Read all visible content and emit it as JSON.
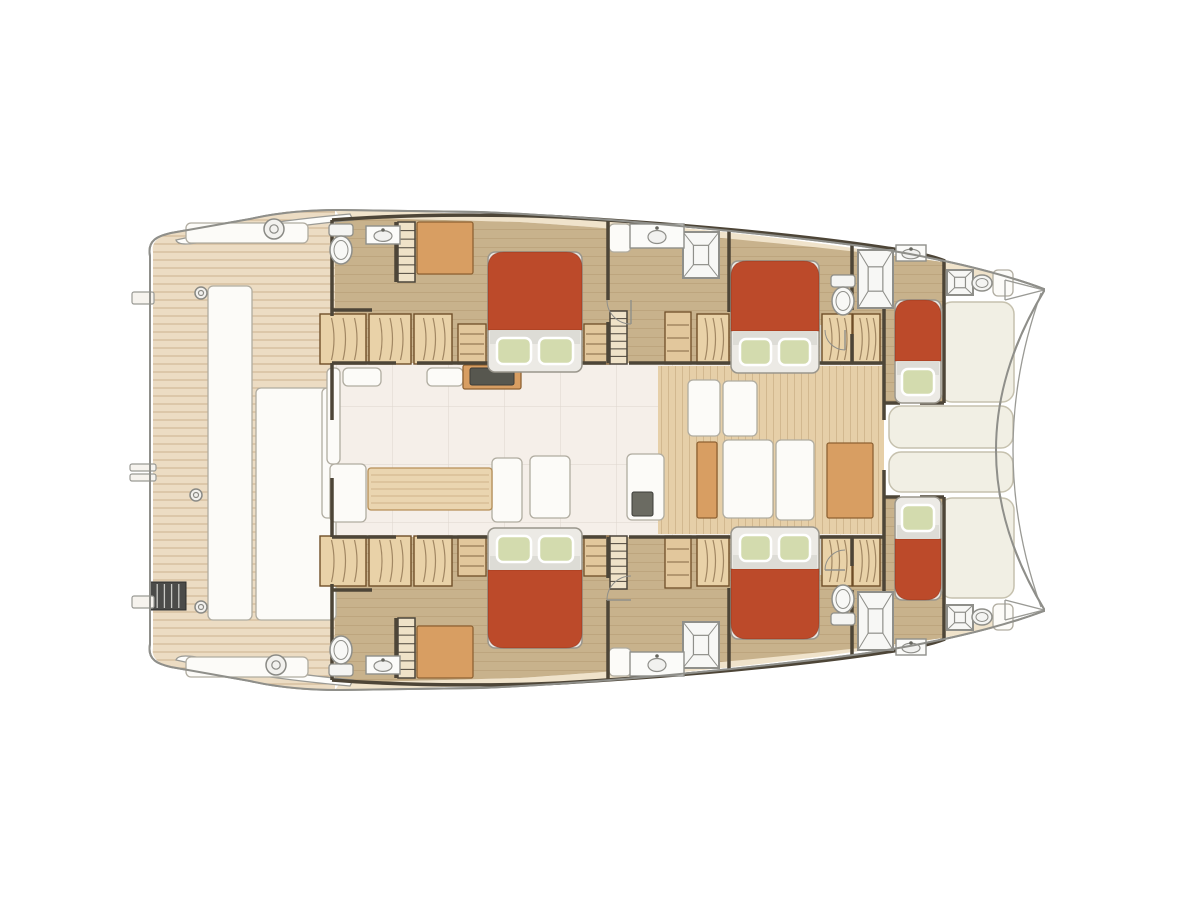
{
  "meta": {
    "title": "catamaran-deck-plan",
    "view": "top-down interior layout, bow right, stern left",
    "hulls": 2,
    "double_cabins": 4,
    "single_forepeak_cabins": 2
  },
  "palette": {
    "hull_outline": "#8f8f8a",
    "wall": "#4d4537",
    "teak": "#ecdcc3",
    "teak_light": "#f0e3cb",
    "cabin_floor": "#c8b28c",
    "fwd_floor": "#e6cfa8",
    "salon_floor": "#f5efe9",
    "gray_floor": "#d2d2cb",
    "bed_red": "#bc4a2a",
    "mattress": "#eceae5",
    "band": "#dddcd6",
    "pillow": "#d3dbae",
    "wood": "#d89e62",
    "wood_light": "#ead5b0",
    "wardrobe": "#e9d2a8",
    "white_furn": "#fcfbf8",
    "cushion": "#f1efe4",
    "fixture": "#8f8f8a",
    "dark_ladder": "#4b4b49"
  },
  "plan": {
    "beds": [
      {
        "n": "bed-port-aft-cabin",
        "x": 488,
        "y": 252,
        "w": 94,
        "h": 120,
        "p": 2,
        "e": "bottom"
      },
      {
        "n": "bed-port-mid-cabin",
        "x": 731,
        "y": 261,
        "w": 88,
        "h": 112,
        "p": 2,
        "e": "bottom"
      },
      {
        "n": "bed-port-forepeak",
        "x": 895,
        "y": 300,
        "w": 46,
        "h": 103,
        "p": 1,
        "e": "bottom"
      },
      {
        "n": "bed-stbd-aft-cabin",
        "x": 488,
        "y": 528,
        "w": 94,
        "h": 120,
        "p": 2,
        "e": "top"
      },
      {
        "n": "bed-stbd-mid-cabin",
        "x": 731,
        "y": 527,
        "w": 88,
        "h": 112,
        "p": 2,
        "e": "top"
      },
      {
        "n": "bed-stbd-forepeak",
        "x": 895,
        "y": 497,
        "w": 46,
        "h": 103,
        "p": 1,
        "e": "top"
      }
    ],
    "showers": [
      {
        "n": "shower-port-mid",
        "x": 683,
        "y": 232,
        "w": 36,
        "h": 46
      },
      {
        "n": "shower-port-fwd",
        "x": 858,
        "y": 250,
        "w": 35,
        "h": 58
      },
      {
        "n": "shower-bow-port",
        "x": 947,
        "y": 270,
        "w": 26,
        "h": 25
      },
      {
        "n": "shower-stbd-mid",
        "x": 683,
        "y": 622,
        "w": 36,
        "h": 46
      },
      {
        "n": "shower-stbd-fwd",
        "x": 858,
        "y": 592,
        "w": 35,
        "h": 58
      },
      {
        "n": "shower-bow-stbd",
        "x": 947,
        "y": 605,
        "w": 26,
        "h": 25
      }
    ],
    "toilets": [
      {
        "n": "toilet-port-aft",
        "cx": 341,
        "cy": 248,
        "dir": "down"
      },
      {
        "n": "toilet-port-fwd",
        "cx": 843,
        "cy": 299,
        "dir": "down"
      },
      {
        "n": "toilet-stbd-aft",
        "cx": 341,
        "cy": 652,
        "dir": "up"
      },
      {
        "n": "toilet-stbd-fwd",
        "cx": 843,
        "cy": 601,
        "dir": "up"
      },
      {
        "n": "toilet-bow-port",
        "cx": 982,
        "cy": 283,
        "mini": true
      },
      {
        "n": "toilet-bow-stbd",
        "cx": 982,
        "cy": 617,
        "mini": true
      }
    ],
    "sinks": [
      {
        "n": "sink-port-aft",
        "x": 366,
        "y": 226,
        "w": 34,
        "h": 18
      },
      {
        "n": "sink-port-mid",
        "x": 630,
        "y": 224,
        "w": 54,
        "h": 24
      },
      {
        "n": "sink-port-fwd",
        "x": 896,
        "y": 245,
        "w": 30,
        "h": 16
      },
      {
        "n": "sink-stbd-aft",
        "x": 366,
        "y": 656,
        "w": 34,
        "h": 18
      },
      {
        "n": "sink-stbd-mid",
        "x": 630,
        "y": 652,
        "w": 54,
        "h": 24
      },
      {
        "n": "sink-stbd-fwd",
        "x": 896,
        "y": 639,
        "w": 30,
        "h": 16
      }
    ],
    "wardrobes": [
      {
        "x": 320,
        "y": 314,
        "w": 46,
        "h": 50
      },
      {
        "x": 369,
        "y": 314,
        "w": 42,
        "h": 50
      },
      {
        "x": 414,
        "y": 314,
        "w": 38,
        "h": 50
      },
      {
        "x": 697,
        "y": 314,
        "w": 32,
        "h": 50
      },
      {
        "x": 822,
        "y": 314,
        "w": 30,
        "h": 50
      },
      {
        "x": 853,
        "y": 314,
        "w": 27,
        "h": 50
      },
      {
        "x": 320,
        "y": 536,
        "w": 46,
        "h": 50
      },
      {
        "x": 369,
        "y": 536,
        "w": 42,
        "h": 50
      },
      {
        "x": 414,
        "y": 536,
        "w": 38,
        "h": 50
      },
      {
        "x": 697,
        "y": 536,
        "w": 32,
        "h": 50
      },
      {
        "x": 822,
        "y": 536,
        "w": 30,
        "h": 50
      },
      {
        "x": 853,
        "y": 536,
        "w": 27,
        "h": 50
      }
    ],
    "shelves": [
      {
        "x": 458,
        "y": 324,
        "w": 28,
        "h": 40
      },
      {
        "x": 584,
        "y": 324,
        "w": 26,
        "h": 40
      },
      {
        "x": 665,
        "y": 312,
        "w": 26,
        "h": 52
      },
      {
        "x": 458,
        "y": 536,
        "w": 28,
        "h": 40
      },
      {
        "x": 584,
        "y": 536,
        "w": 26,
        "h": 40
      },
      {
        "x": 665,
        "y": 536,
        "w": 26,
        "h": 52
      }
    ],
    "stairs": [
      {
        "n": "stairs-port-aft",
        "x": 398,
        "y": 222,
        "w": 17,
        "h": 60
      },
      {
        "n": "stairs-port-mid",
        "x": 610,
        "y": 311,
        "w": 17,
        "h": 53
      },
      {
        "n": "stairs-stbd-aft",
        "x": 398,
        "y": 618,
        "w": 17,
        "h": 60
      },
      {
        "n": "stairs-stbd-mid",
        "x": 610,
        "y": 536,
        "w": 17,
        "h": 53
      }
    ],
    "cushions": [
      {
        "n": "foredeck-pad-port",
        "x": 940,
        "y": 302,
        "w": 74,
        "h": 100
      },
      {
        "n": "foredeck-pad-mid-a",
        "x": 889,
        "y": 406,
        "w": 124,
        "h": 42
      },
      {
        "n": "foredeck-pad-mid-b",
        "x": 889,
        "y": 452,
        "w": 124,
        "h": 40
      },
      {
        "n": "foredeck-pad-stbd",
        "x": 940,
        "y": 498,
        "w": 74,
        "h": 100
      }
    ],
    "white_furniture": [
      {
        "n": "aft-bench-port",
        "x": 186,
        "y": 223,
        "w": 122,
        "h": 20
      },
      {
        "n": "aft-bench-stbd",
        "x": 186,
        "y": 657,
        "w": 122,
        "h": 20
      },
      {
        "n": "cockpit-bench",
        "x": 208,
        "y": 286,
        "w": 44,
        "h": 334
      },
      {
        "n": "cockpit-lounge",
        "x": 256,
        "y": 388,
        "w": 80,
        "h": 232
      },
      {
        "n": "salon-sliding-door",
        "x": 322,
        "y": 388,
        "w": 14,
        "h": 130
      },
      {
        "n": "salon-sofa-left",
        "x": 327,
        "y": 368,
        "w": 13,
        "h": 96
      },
      {
        "n": "dinette-seat-aft",
        "x": 330,
        "y": 464,
        "w": 36,
        "h": 58
      },
      {
        "n": "dinette-seat-fwd",
        "x": 492,
        "y": 458,
        "w": 30,
        "h": 64
      },
      {
        "n": "salon-island-seat",
        "x": 530,
        "y": 456,
        "w": 40,
        "h": 62
      },
      {
        "n": "salon-cabinet-a",
        "x": 343,
        "y": 368,
        "w": 38,
        "h": 18
      },
      {
        "n": "salon-cabinet-b",
        "x": 427,
        "y": 368,
        "w": 36,
        "h": 18
      },
      {
        "n": "galley-sink-counter",
        "x": 627,
        "y": 454,
        "w": 37,
        "h": 66
      },
      {
        "n": "fwd-door-panel",
        "x": 723,
        "y": 440,
        "w": 50,
        "h": 78
      },
      {
        "n": "fwd-locker-panel",
        "x": 776,
        "y": 440,
        "w": 38,
        "h": 80
      },
      {
        "n": "glass-door-a",
        "x": 688,
        "y": 380,
        "w": 32,
        "h": 56
      },
      {
        "n": "glass-door-b",
        "x": 723,
        "y": 381,
        "w": 34,
        "h": 55
      },
      {
        "n": "head-shelf-port",
        "x": 609,
        "y": 224,
        "w": 22,
        "h": 28
      },
      {
        "n": "head-shelf-stbd",
        "x": 609,
        "y": 648,
        "w": 22,
        "h": 28
      },
      {
        "n": "bow-locker-port",
        "x": 993,
        "y": 270,
        "w": 20,
        "h": 26
      },
      {
        "n": "bow-locker-stbd",
        "x": 993,
        "y": 604,
        "w": 20,
        "h": 26
      }
    ],
    "wood_furniture": [
      {
        "n": "desk-port",
        "x": 417,
        "y": 222,
        "w": 56,
        "h": 52
      },
      {
        "n": "desk-stbd",
        "x": 417,
        "y": 626,
        "w": 56,
        "h": 52
      },
      {
        "n": "galley-range-counter",
        "x": 463,
        "y": 365,
        "w": 58,
        "h": 24
      },
      {
        "n": "fwd-wood-pillar",
        "x": 697,
        "y": 442,
        "w": 20,
        "h": 76
      },
      {
        "n": "fwd-cabinet",
        "x": 827,
        "y": 443,
        "w": 46,
        "h": 75
      }
    ],
    "tables": [
      {
        "n": "dinette-table",
        "x": 368,
        "y": 468,
        "w": 124,
        "h": 42
      }
    ],
    "dark_rects": [
      {
        "n": "cooktop",
        "x": 470,
        "y": 368,
        "w": 44,
        "h": 17,
        "f": "#57574f"
      },
      {
        "n": "galley-sink-basin",
        "x": 632,
        "y": 492,
        "w": 21,
        "h": 24,
        "f": "#6b6b62"
      }
    ],
    "gray_floors": [
      {
        "n": "fwd-bath-vestibule-port",
        "x": 820,
        "y": 325,
        "w": 58,
        "h": 38
      },
      {
        "n": "fwd-bath-vestibule-stbd",
        "x": 820,
        "y": 537,
        "w": 58,
        "h": 38
      }
    ],
    "deck_circles": [
      {
        "cx": 274,
        "cy": 229,
        "r": 10
      },
      {
        "cx": 276,
        "cy": 665,
        "r": 10
      },
      {
        "cx": 201,
        "cy": 293,
        "r": 6
      },
      {
        "cx": 196,
        "cy": 495,
        "r": 6
      },
      {
        "cx": 201,
        "cy": 607,
        "r": 6
      }
    ],
    "ladder": {
      "n": "swim-ladder",
      "x": 150,
      "y": 582,
      "w": 36,
      "h": 28
    },
    "steps": [
      {
        "x": 132,
        "y": 292,
        "w": 22,
        "h": 12
      },
      {
        "x": 130,
        "y": 464,
        "w": 26,
        "h": 7
      },
      {
        "x": 130,
        "y": 474,
        "w": 26,
        "h": 7
      },
      {
        "x": 132,
        "y": 596,
        "w": 22,
        "h": 12
      }
    ],
    "door_arcs": [
      {
        "cx": 631,
        "cy": 300,
        "r": 24,
        "a1": 90,
        "a2": 180
      },
      {
        "cx": 631,
        "cy": 600,
        "r": 24,
        "a1": 180,
        "a2": 270
      },
      {
        "cx": 845,
        "cy": 330,
        "r": 20,
        "a1": 90,
        "a2": 180
      },
      {
        "cx": 845,
        "cy": 570,
        "r": 20,
        "a1": 180,
        "a2": 270
      }
    ]
  }
}
